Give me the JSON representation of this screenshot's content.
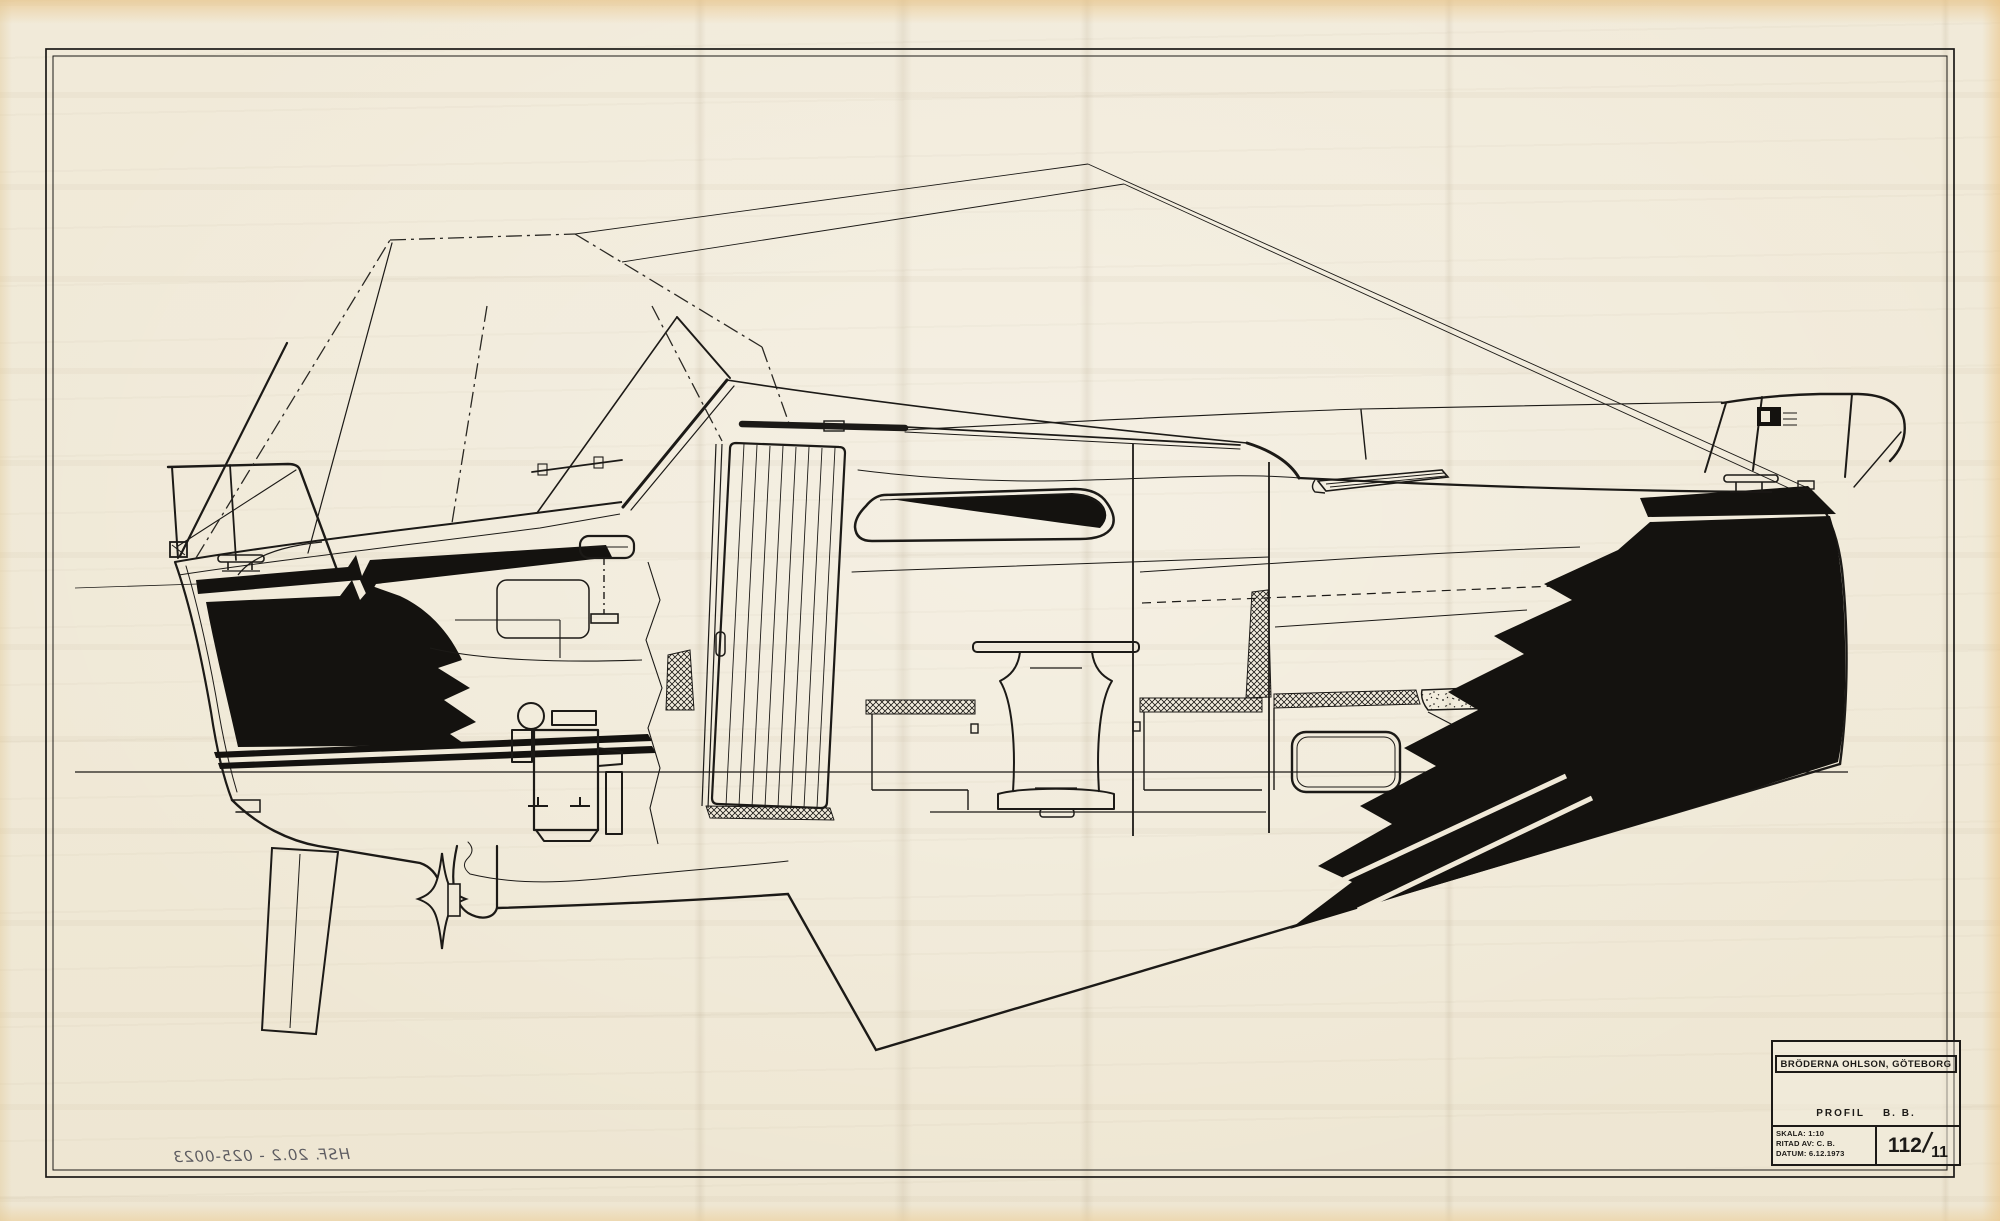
{
  "colors": {
    "paper": "#f0e9d8",
    "ink": "#1c1a17",
    "aged_edge": "#e9c180"
  },
  "drawing": {
    "subject": "motorboat-profile-cutaway"
  },
  "title_block": {
    "company": "BRÖDERNA OHLSON, GÖTEBORG",
    "view_label": "PROFIL",
    "view_side": "B. B.",
    "scale_label": "SKALA:",
    "scale_value": "1:10",
    "drawn_by_label": "RITAD AV:",
    "drawn_by_value": "C. B.",
    "date_label": "DATUM:",
    "date_value": "6.12.1973",
    "sheet_number": "112",
    "sheet_slash": "/",
    "sheet_number_sub": "11"
  },
  "annotations": {
    "reverse_side_number": "HSF. 20.2 - 025-0023"
  }
}
